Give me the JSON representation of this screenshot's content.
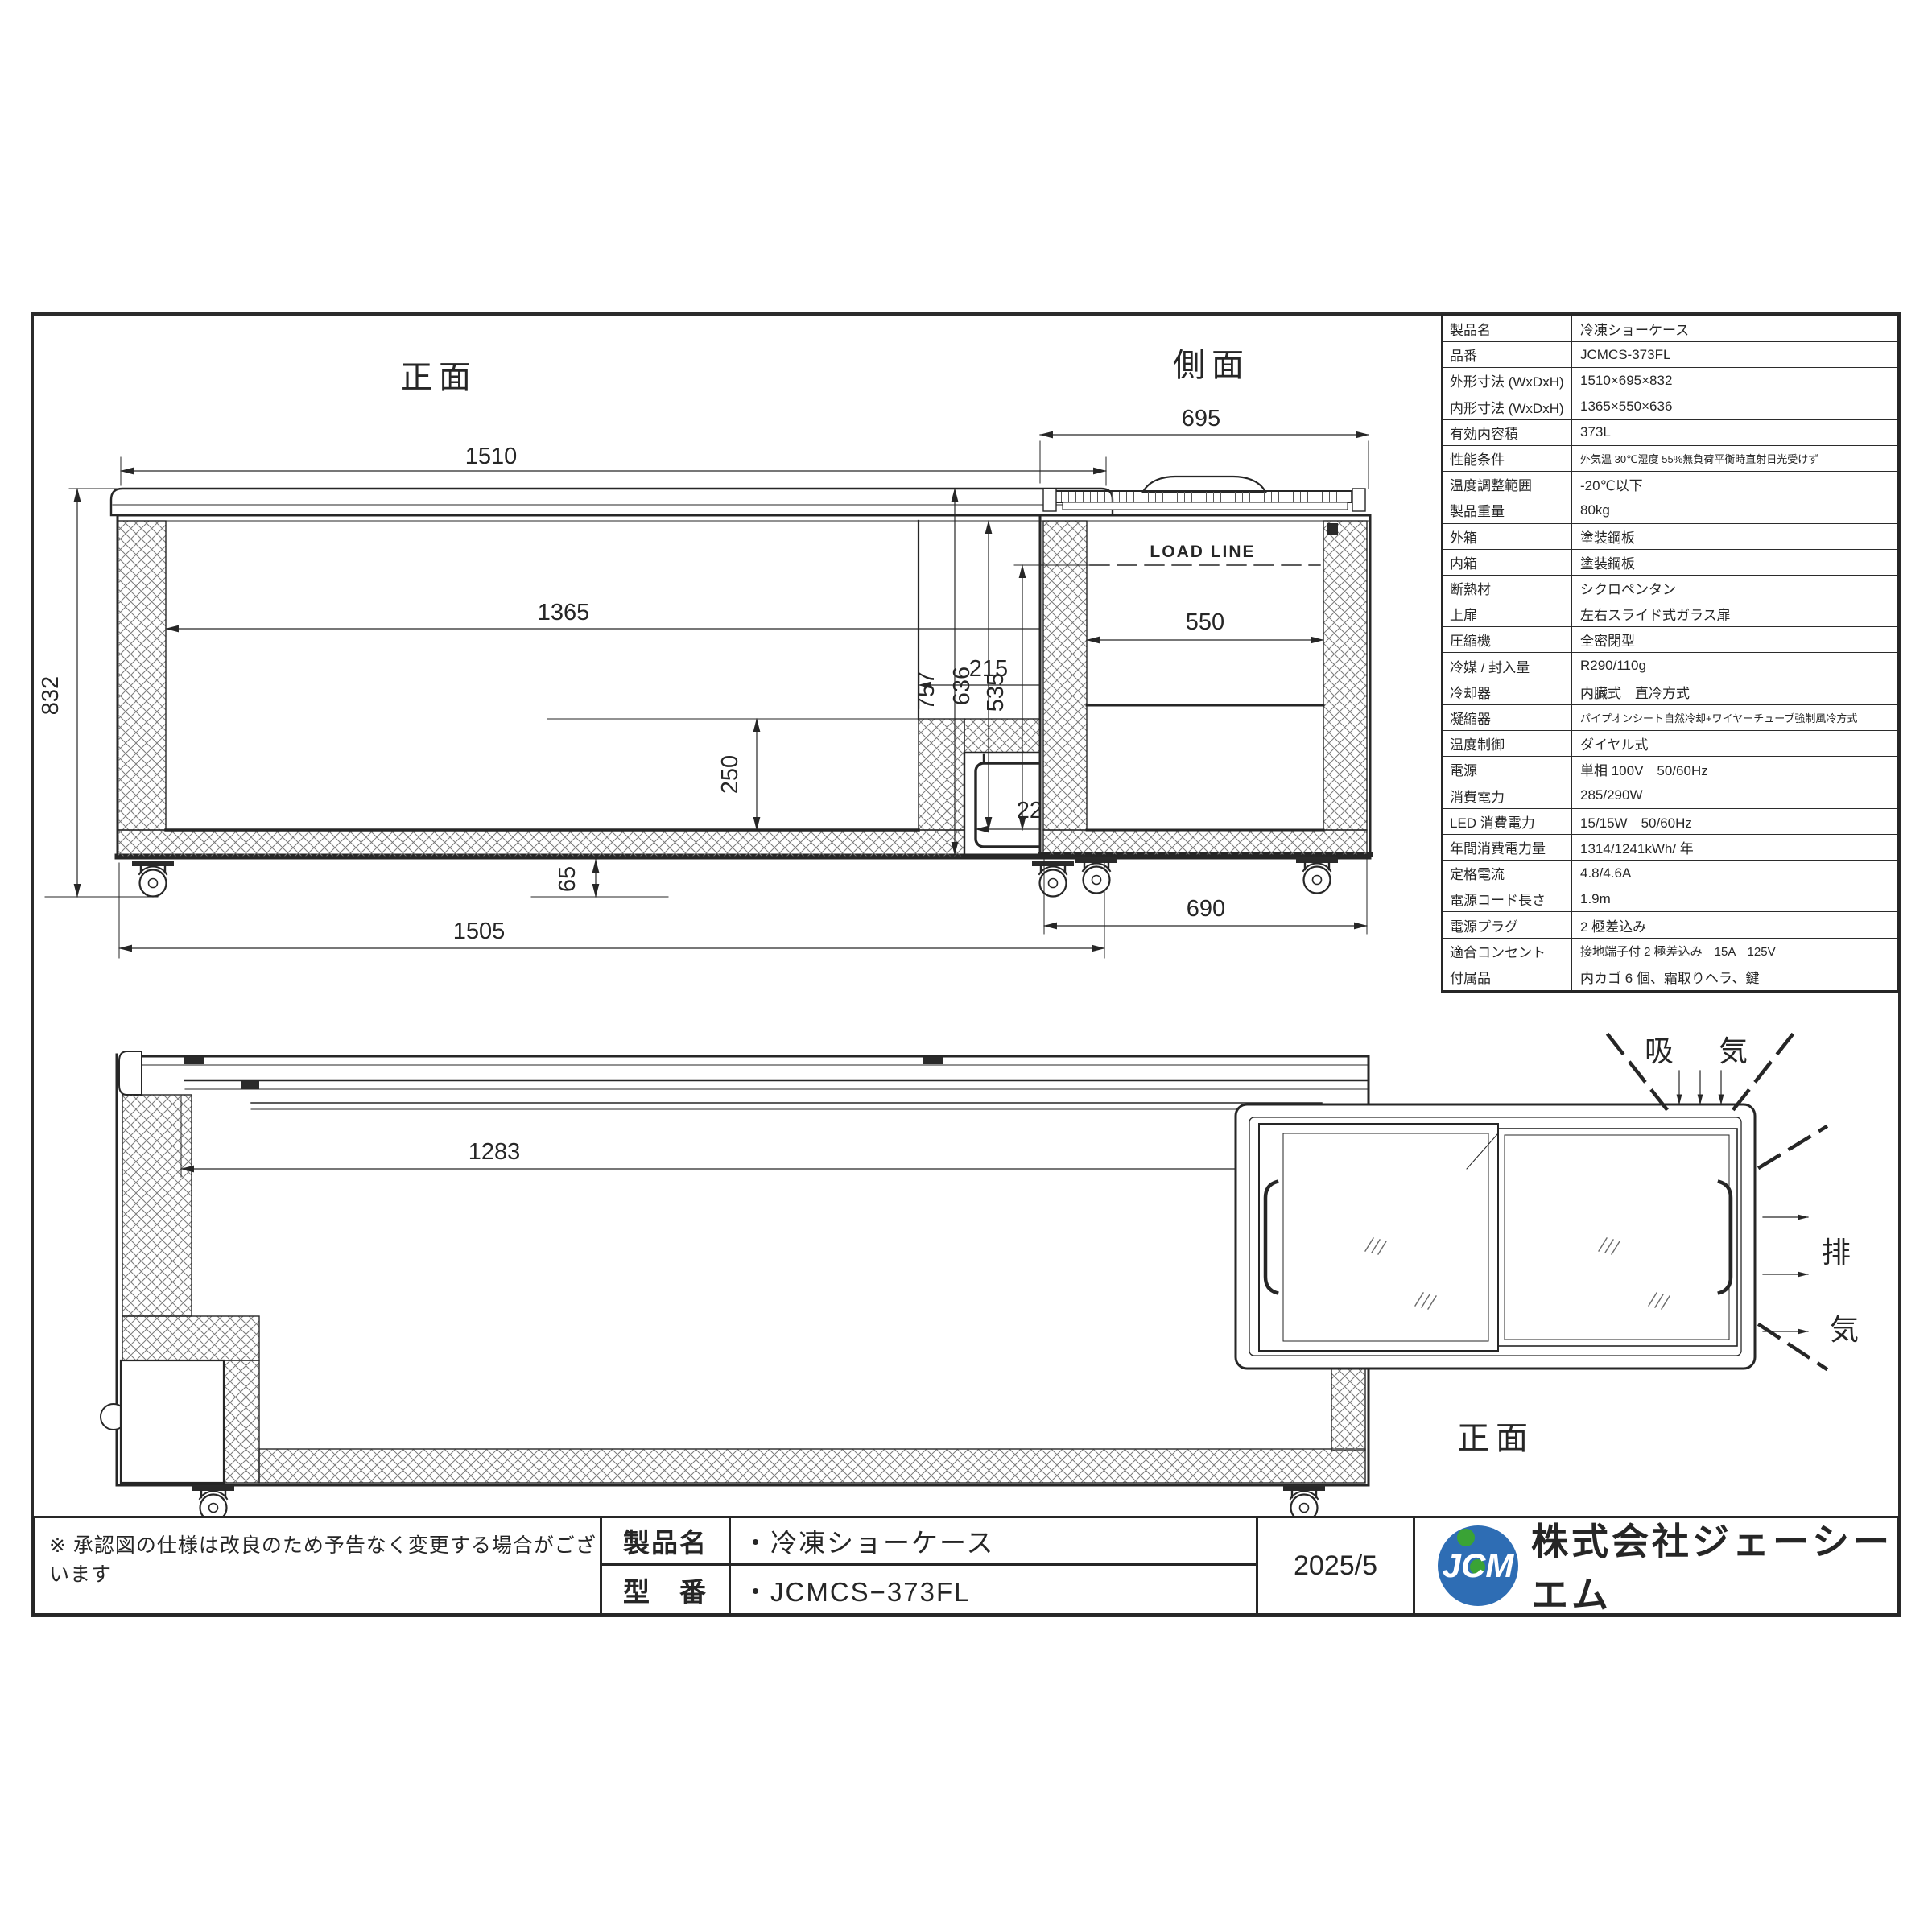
{
  "sheet": {
    "note": "※ 承認図の仕様は改良のため予告なく変更する場合がございます",
    "date": "2025/5",
    "company": "株式会社ジェーシーエム",
    "logo_text": "JCM",
    "title_block": {
      "product_label": "製品名",
      "product_value": "・冷凍ショーケース",
      "model_label": "型　番",
      "model_value": "・JCMCS−373FL"
    }
  },
  "spec_table": {
    "rows": [
      {
        "label": "製品名",
        "value": "冷凍ショーケース"
      },
      {
        "label": "品番",
        "value": "JCMCS-373FL"
      },
      {
        "label": "外形寸法 (WxDxH)",
        "value": "1510×695×832"
      },
      {
        "label": "内形寸法 (WxDxH)",
        "value": "1365×550×636"
      },
      {
        "label": "有効内容積",
        "value": "373L"
      },
      {
        "label": "性能条件",
        "value": "外気温 30℃湿度 55%無負荷平衡時直射日光受けず"
      },
      {
        "label": "温度調整範囲",
        "value": "-20℃以下"
      },
      {
        "label": "製品重量",
        "value": "80kg"
      },
      {
        "label": "外箱",
        "value": "塗装鋼板"
      },
      {
        "label": "内箱",
        "value": "塗装鋼板"
      },
      {
        "label": "断熱材",
        "value": "シクロペンタン"
      },
      {
        "label": "上扉",
        "value": "左右スライド式ガラス扉"
      },
      {
        "label": "圧縮機",
        "value": "全密閉型"
      },
      {
        "label": "冷媒 / 封入量",
        "value": "R290/110g"
      },
      {
        "label": "冷却器",
        "value": "内臓式　直冷方式"
      },
      {
        "label": "凝縮器",
        "value": "パイプオンシート自然冷却+ワイヤーチューブ強制風冷方式"
      },
      {
        "label": "温度制御",
        "value": "ダイヤル式"
      },
      {
        "label": "電源",
        "value": "単相 100V　50/60Hz"
      },
      {
        "label": "消費電力",
        "value": "285/290W"
      },
      {
        "label": "LED 消費電力",
        "value": "15/15W　50/60Hz"
      },
      {
        "label": "年間消費電力量",
        "value": "1314/1241kWh/ 年"
      },
      {
        "label": "定格電流",
        "value": "4.8/4.6A"
      },
      {
        "label": "電源コード長さ",
        "value": "1.9m"
      },
      {
        "label": "電源プラグ",
        "value": "2 極差込み"
      },
      {
        "label": "適合コンセント",
        "value": "接地端子付 2 極差込み　15A　125V"
      },
      {
        "label": "付属品",
        "value": "内カゴ 6 個、霜取りヘラ、鍵"
      }
    ]
  },
  "views": {
    "front": {
      "title": "正面",
      "dim_width_top": "1510",
      "dim_inner_width": "1365",
      "dim_step_width": "215",
      "dim_height": "832",
      "dim_step_height": "250",
      "dim_comp_width": "220",
      "dim_comp_height": "250",
      "dim_base_height": "65",
      "dim_width_bottom": "1505"
    },
    "side": {
      "title": "側面",
      "load_line": "LOAD LINE",
      "dim_depth_top": "695",
      "dim_inner_depth": "550",
      "dim_height": "757",
      "dim_inner_height": "636",
      "dim_load_depth": "535",
      "dim_depth_bottom": "690"
    },
    "back": {
      "title": "背面",
      "dim_glass_width": "1283"
    },
    "top": {
      "title": "正面",
      "intake_label": "吸　気",
      "exhaust_chars": [
        "排",
        "気"
      ]
    }
  },
  "colors": {
    "line": "#262626",
    "logo_blue": "#2e6db4",
    "logo_green": "#3aa335"
  }
}
